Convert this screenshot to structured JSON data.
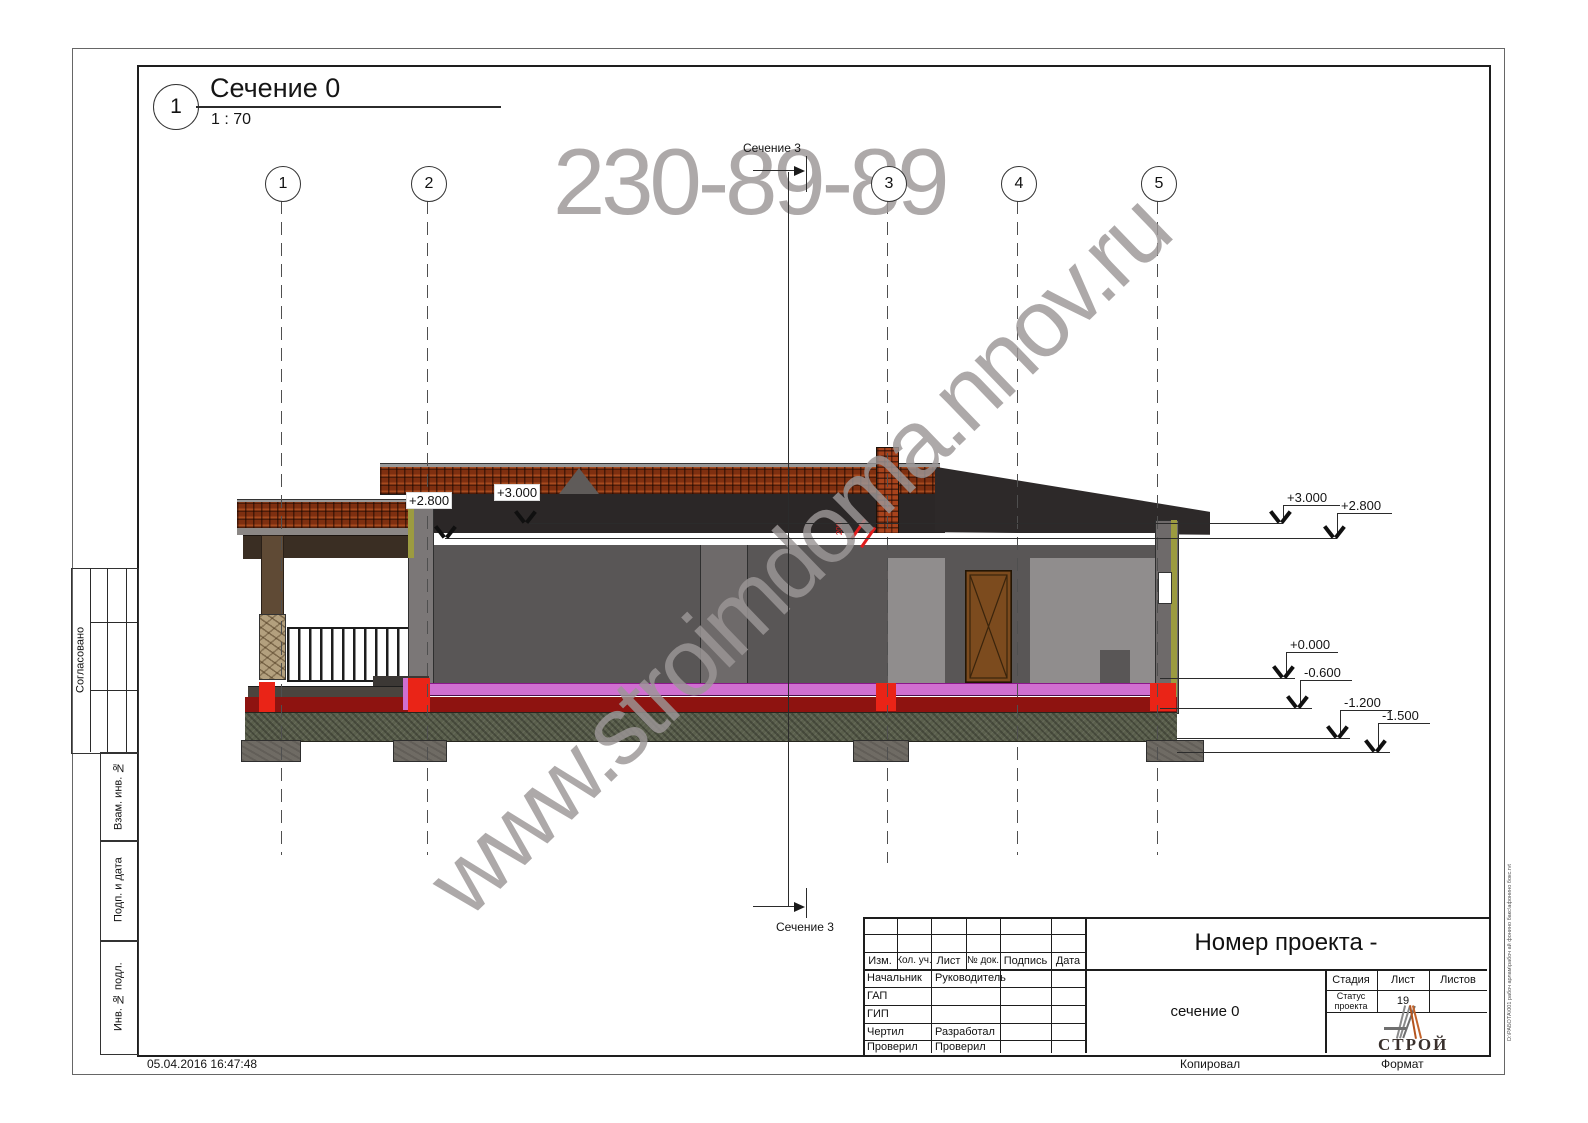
{
  "view": {
    "number": "1",
    "title": "Сечение 0",
    "scale": "1 : 70"
  },
  "grid": [
    "1",
    "2",
    "3",
    "4",
    "5"
  ],
  "section": {
    "label": "Сечение 3"
  },
  "elevations": {
    "left": [
      "+2.800",
      "+3.000"
    ],
    "right": [
      "+3.000",
      "+2.800",
      "+0.000",
      "-0.600",
      "-1.200",
      "-1.500"
    ]
  },
  "notes": {
    "red_mark": "200"
  },
  "watermark": {
    "phone": "230-89-89",
    "site": "www.stroimdoma.nnov.ru"
  },
  "sidebar": [
    "Согласовано",
    "Взам. инв. №",
    "Подп. и дата",
    "Инв. № подл."
  ],
  "stamp": {
    "headers": [
      "Изм.",
      "Кол. уч.",
      "Лист",
      "№ док.",
      "Подпись",
      "Дата"
    ],
    "rows": [
      [
        "Начальник",
        "Руководитель"
      ],
      [
        "ГАП",
        ""
      ],
      [
        "ГИП",
        ""
      ],
      [
        "Чертил",
        "Разработал"
      ],
      [
        "Проверил",
        "Проверил"
      ]
    ],
    "project_title": "Номер проекта -",
    "sheet_name": "сечение 0",
    "stage_label": "Стадия",
    "sheet_label": "Лист",
    "sheets_label": "Листов",
    "stage_value": "Статус проекта",
    "sheet_value": "19",
    "sheets_value": "",
    "logo_text": "СТРОЙ"
  },
  "footer": {
    "timestamp": "05.04.2016 16:47:48",
    "copied": "Копировал",
    "format": "Формат",
    "path": "D:\\РАБОТА\\001 рабоч арлам\\рабоч ай фонино бакс\\афонино бокс.rvt"
  },
  "colors": {
    "roof_tile": "#7e2f10",
    "roof_dark": "#2d2929",
    "wall_gray": "#595656",
    "floor_pink": "#d06fd0",
    "floor_red_dark": "#8e1310",
    "cut_red": "#ea2417",
    "ground_olive": "#5a5f4c",
    "edge_olive": "#9c9b40",
    "logo_orange": "#b4541e"
  }
}
